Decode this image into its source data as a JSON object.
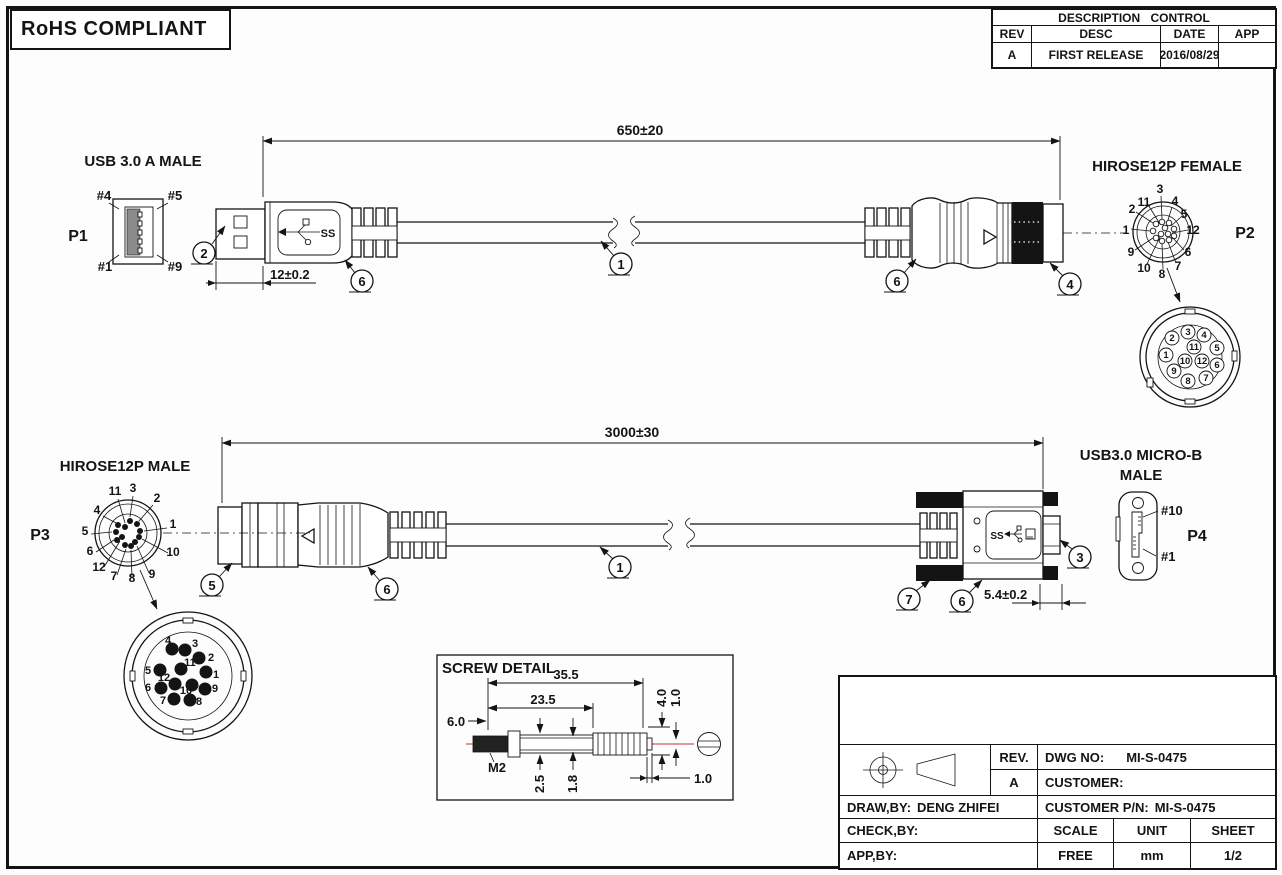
{
  "page": {
    "rohs": "RoHS COMPLIANT"
  },
  "revision_table": {
    "title": "DESCRIPTION CONTROL",
    "col_rev": "REV",
    "col_desc": "DESC",
    "col_date": "DATE",
    "col_app": "APP",
    "row_rev": "A",
    "row_desc": "FIRST RELEASE",
    "row_date": "2016/08/29",
    "row_app": ""
  },
  "pin_numbers": [
    "1",
    "2",
    "3",
    "4",
    "5",
    "6",
    "7",
    "8",
    "9",
    "10",
    "11",
    "12"
  ],
  "assembly1": {
    "length_dim": "650±20",
    "plug_dim": "12±0.2",
    "left": {
      "title": "USB 3.0 A MALE",
      "ref": "P1",
      "pin_tl": "#4",
      "pin_tr": "#5",
      "pin_bl": "#1",
      "pin_br": "#9"
    },
    "right": {
      "title": "HIROSE12P FEMALE",
      "ref": "P2"
    }
  },
  "assembly2": {
    "length_dim": "3000±30",
    "plug_dim": "5.4±0.2",
    "left": {
      "title": "HIROSE12P MALE",
      "ref": "P3"
    },
    "right": {
      "title_line1": "USB3.0 MICRO-B",
      "title_line2": "MALE",
      "ref": "P4",
      "pin_top": "#10",
      "pin_bottom": "#1"
    }
  },
  "balloons": {
    "n1": "1",
    "n2": "2",
    "n3": "3",
    "n4": "4",
    "n5": "5",
    "n6": "6",
    "n7": "7"
  },
  "usb_logo_text": "SS",
  "screw_detail": {
    "title": "SCREW DETAIL",
    "dim_overall": "35.5",
    "dim_shaft_len": "23.5",
    "dim_thread_len": "6.0",
    "thread_spec": "M2",
    "dim_collar_dia": "2.5",
    "dim_shaft_dia": "1.8",
    "dim_head_dia": "4.0",
    "dim_slot_width": "1.0",
    "dim_tip": "1.0"
  },
  "title_block": {
    "rev_label": "REV.",
    "rev_value": "A",
    "dwg_no_label": "DWG NO:",
    "dwg_no_value": "MI-S-0475",
    "customer_label": "CUSTOMER:",
    "customer_value": "",
    "draw_by_label": "DRAW,BY:",
    "draw_by_value": "DENG ZHIFEI",
    "customer_pn_label": "CUSTOMER P/N:",
    "customer_pn_value": "MI-S-0475",
    "check_by_label": "CHECK,BY:",
    "check_by_value": "",
    "app_by_label": "APP,BY:",
    "app_by_value": "",
    "scale_label": "SCALE",
    "scale_value": "FREE",
    "unit_label": "UNIT",
    "unit_value": "mm",
    "sheet_label": "SHEET",
    "sheet_value": "1/2"
  }
}
